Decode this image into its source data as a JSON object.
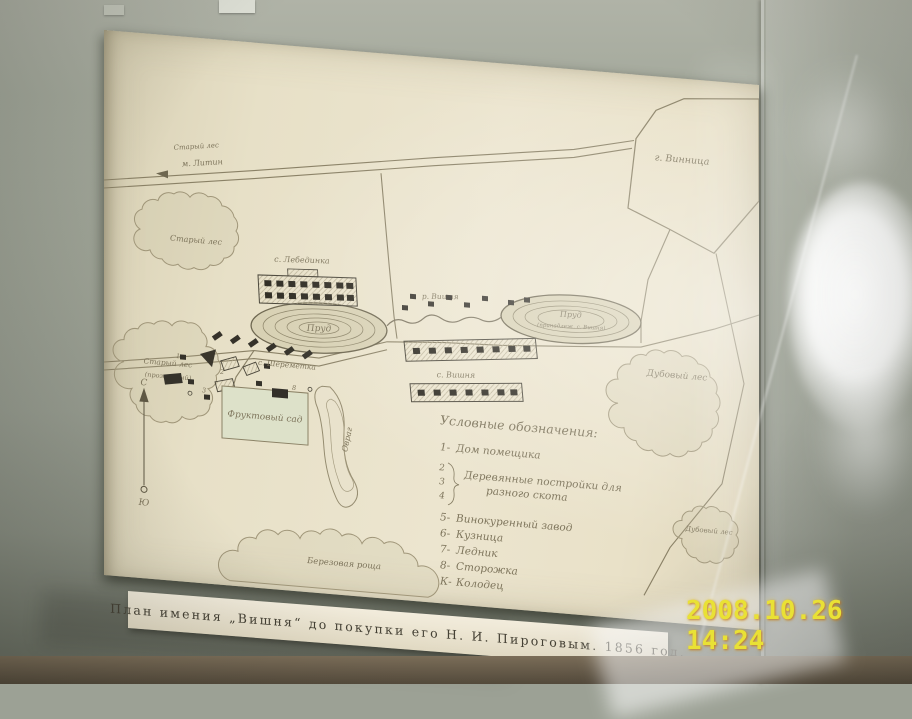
{
  "photo": {
    "timestamp": "2008.10.26 14:24",
    "timestamp_color": "#e9e135",
    "wall_color": "#9ca195",
    "paper_color": "#e9e2ca",
    "ink_color": "#7e755c"
  },
  "caption": {
    "text": "План имения „Вишня“ до покупки его Н. И. Пироговым. 1856 год."
  },
  "map": {
    "labels": {
      "forest_top_small": "Старый лес",
      "road_litin": "м. Литин",
      "city_vinnitsa": "г. Винница",
      "forest_upper_left": "Старый лес",
      "forest_lower_left_line1": "Старый лес",
      "forest_lower_left_line2": "(прозванный)",
      "village_north": "с. Лебединка",
      "pond_left": "Пруд",
      "village_sheremetka": "с. Шереметка",
      "river_vishnya": "р. Вишня",
      "village_vishnya": "с. Вишня",
      "pond_right": "Пруд",
      "pond_right_note": "(принадлеж. с. Вишня)",
      "forest_right": "Дубовый лес",
      "forest_bottom_right": "Дубовый лес",
      "grove_bottom": "Березовая роща",
      "orchard": "Фруктовый сад",
      "ravine": "Овраг",
      "compass_north": "С",
      "compass_south": "Ю"
    },
    "legend": {
      "title": "Условные обозначения:",
      "items": [
        {
          "key": "1-",
          "label": "Дом помещика"
        },
        {
          "keys": [
            "2",
            "3",
            "4"
          ],
          "label": "Деревянные постройки для",
          "label2": "разного скота"
        },
        {
          "key": "5-",
          "label": "Винокуренный завод"
        },
        {
          "key": "6-",
          "label": "Кузница"
        },
        {
          "key": "7-",
          "label": "Ледник"
        },
        {
          "key": "8-",
          "label": "Сторожка"
        },
        {
          "key": "К-",
          "label": "Колодец"
        }
      ]
    },
    "estate_numbers": [
      "1",
      "2",
      "3",
      "5",
      "8"
    ]
  }
}
